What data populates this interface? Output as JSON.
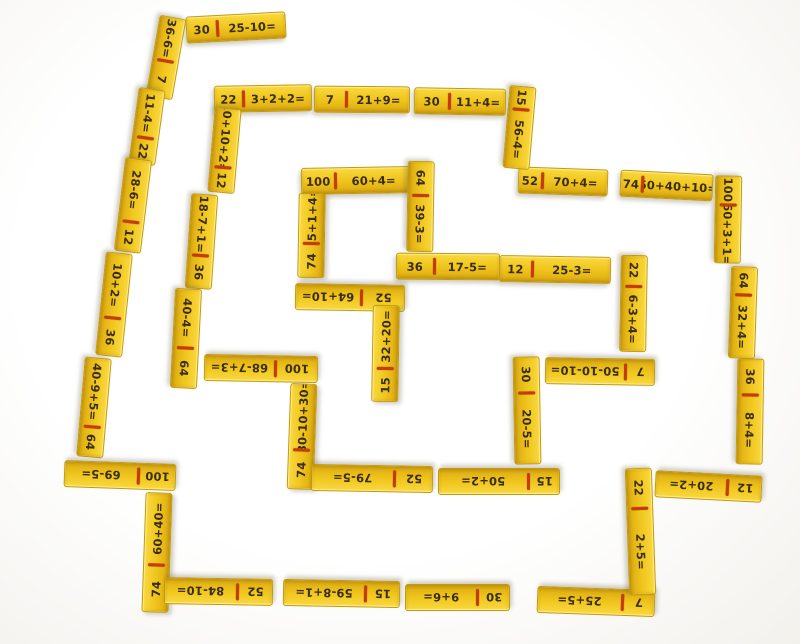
{
  "meta": {
    "description": "Photo of yellow wooden arithmetic domino tiles arranged in a rectangular spiral maze on a white surface; each tile shows a number half and an expression half separated by a red line"
  },
  "palette": {
    "background": "#ffffff",
    "tile_top": "#f9d83e",
    "tile_mid": "#f0c61e",
    "tile_bottom": "#ddab10",
    "tile_border": "#c49a0a",
    "divider": "#c63c08",
    "text": "#3b2d10"
  },
  "tile_thickness": 27,
  "tiles": [
    {
      "a": "30",
      "b": "25-10=",
      "x": 236,
      "y": 27,
      "l": 100,
      "r": -3,
      "wa": 30
    },
    {
      "a": "36-6=",
      "b": "7",
      "x": 166,
      "y": 57,
      "l": 82,
      "r": 100,
      "wa": 52
    },
    {
      "a": "11-4=",
      "b": "22",
      "x": 147,
      "y": 126,
      "l": 76,
      "r": 98,
      "wa": 64
    },
    {
      "a": "28-6=",
      "b": "12",
      "x": 133,
      "y": 205,
      "l": 94,
      "r": 97,
      "wa": 66
    },
    {
      "a": "10+2=",
      "b": "36",
      "x": 114,
      "y": 304,
      "l": 104,
      "r": 96,
      "wa": 62
    },
    {
      "a": "40-9+5=",
      "b": "64",
      "x": 94,
      "y": 407,
      "l": 100,
      "r": 95,
      "wa": 68
    },
    {
      "a": "100",
      "b": "69-5=",
      "x": 120,
      "y": 475,
      "l": 112,
      "r": 182,
      "wa": 32
    },
    {
      "a": "74",
      "b": "60+40=",
      "x": 157,
      "y": 552,
      "l": 120,
      "r": -88,
      "wa": 38
    },
    {
      "a": "52",
      "b": "84-10=",
      "x": 218,
      "y": 591,
      "l": 109,
      "r": 181,
      "wa": 31
    },
    {
      "a": "15",
      "b": "59-8+1=",
      "x": 341,
      "y": 593,
      "l": 117,
      "r": 181,
      "wa": 28
    },
    {
      "a": "30",
      "b": "9+6=",
      "x": 457,
      "y": 597,
      "l": 105,
      "r": 180,
      "wa": 29
    },
    {
      "a": "7",
      "b": "25+5=",
      "x": 596,
      "y": 601,
      "l": 118,
      "r": 182,
      "wa": 26
    },
    {
      "a": "22",
      "b": "2+5=",
      "x": 640,
      "y": 531,
      "l": 127,
      "r": 88,
      "wa": 30
    },
    {
      "a": "12",
      "b": "20+2=",
      "x": 708,
      "y": 486,
      "l": 107,
      "r": 183,
      "wa": 30
    },
    {
      "a": "36",
      "b": "8+4=",
      "x": 750,
      "y": 411,
      "l": 106,
      "r": 91,
      "wa": 33
    },
    {
      "a": "64",
      "b": "32+4=",
      "x": 743,
      "y": 312,
      "l": 92,
      "r": 92,
      "wa": 29
    },
    {
      "a": "100",
      "b": "60+3+1=",
      "x": 728,
      "y": 219,
      "l": 88,
      "r": 91,
      "wa": 31
    },
    {
      "a": "74",
      "b": "50+40+10=",
      "x": 666,
      "y": 185,
      "l": 93,
      "r": 3,
      "wa": 22
    },
    {
      "a": "52",
      "b": "70+4=",
      "x": 563,
      "y": 181,
      "l": 90,
      "r": 2,
      "wa": 25
    },
    {
      "a": "15",
      "b": "56-4=",
      "x": 519,
      "y": 127,
      "l": 83,
      "r": 95,
      "wa": 26
    },
    {
      "a": "30",
      "b": "11+4=",
      "x": 460,
      "y": 101,
      "l": 92,
      "r": 1,
      "wa": 37
    },
    {
      "a": "7",
      "b": "21+9=",
      "x": 362,
      "y": 99,
      "l": 96,
      "r": 0.5,
      "wa": 32
    },
    {
      "a": "22",
      "b": "3+2+2=",
      "x": 263,
      "y": 98,
      "l": 98,
      "r": -1,
      "wa": 28
    },
    {
      "a": "10+10+2=",
      "b": "12",
      "x": 224,
      "y": 150,
      "l": 85,
      "r": 95,
      "wa": 69
    },
    {
      "a": "18-7+1=",
      "b": "36",
      "x": 201,
      "y": 241,
      "l": 95,
      "r": 94,
      "wa": 63
    },
    {
      "a": "40-4=",
      "b": "64",
      "x": 186,
      "y": 338,
      "l": 100,
      "r": 93,
      "wa": 58
    },
    {
      "a": "100",
      "b": "68-7+3=",
      "x": 261,
      "y": 368,
      "l": 114,
      "r": 181,
      "wa": 36
    },
    {
      "a": "74",
      "b": "80-10+30=",
      "x": 302,
      "y": 436,
      "l": 106,
      "r": -88,
      "wa": 36
    },
    {
      "a": "52",
      "b": "79-5=",
      "x": 372,
      "y": 478,
      "l": 122,
      "r": 181,
      "wa": 30
    },
    {
      "a": "15",
      "b": "50+2=",
      "x": 499,
      "y": 481,
      "l": 122,
      "r": 180,
      "wa": 24
    },
    {
      "a": "30",
      "b": "20-5=",
      "x": 527,
      "y": 410,
      "l": 108,
      "r": 89,
      "wa": 32
    },
    {
      "a": "7",
      "b": "50-10-10=",
      "x": 600,
      "y": 371,
      "l": 110,
      "r": 181,
      "wa": 25
    },
    {
      "a": "22",
      "b": "6-3+4=",
      "x": 633,
      "y": 303,
      "l": 97,
      "r": 91,
      "wa": 30
    },
    {
      "a": "12",
      "b": "25-3=",
      "x": 555,
      "y": 269,
      "l": 112,
      "r": 1,
      "wa": 28
    },
    {
      "a": "36",
      "b": "17-5=",
      "x": 448,
      "y": 266,
      "l": 104,
      "r": 0.5,
      "wa": 35
    },
    {
      "a": "100",
      "b": "60+4=",
      "x": 356,
      "y": 180,
      "l": 110,
      "r": -1,
      "wa": 30
    },
    {
      "a": "64",
      "b": "39-3=",
      "x": 420,
      "y": 206,
      "l": 91,
      "r": 91,
      "wa": 36
    },
    {
      "a": "74",
      "b": "95+1+4=",
      "x": 311,
      "y": 235,
      "l": 85,
      "r": -89,
      "wa": 38
    },
    {
      "a": "52",
      "b": "64+10=",
      "x": 350,
      "y": 297,
      "l": 110,
      "r": 181,
      "wa": 38
    },
    {
      "a": "15",
      "b": "32+20=",
      "x": 385,
      "y": 353,
      "l": 97,
      "r": -89,
      "wa": 33
    }
  ]
}
